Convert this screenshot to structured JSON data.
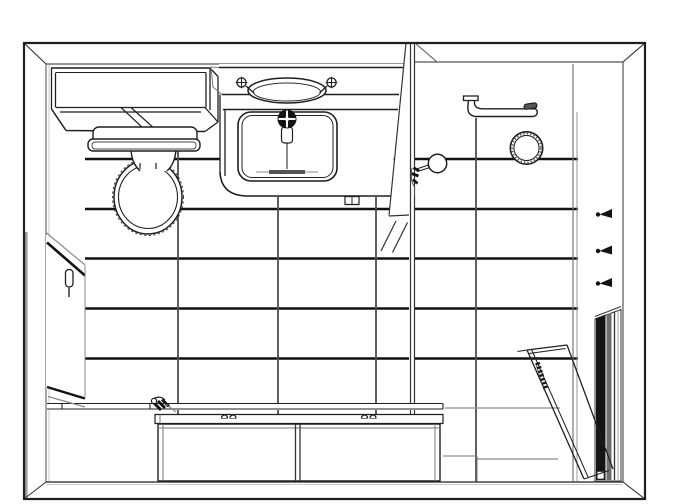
{
  "palette": {
    "paper": "#ffffff",
    "ink": "#1f1f1f",
    "heavy_line": "#111111",
    "mid_line": "#4f4f4f",
    "light_line": "#8a8a8a",
    "dark_fill": "#141414",
    "steel_fill": "#6e6e6e",
    "track_gray": "#555555"
  },
  "scene": {
    "type": "cad_line_drawing",
    "view": "one-point perspective interior elevation of a bathroom, black line art on white, no text",
    "room": {
      "frame_px": {
        "x": 24,
        "y": 43,
        "w": 621,
        "h": 456
      },
      "tile_rows_y": [
        159,
        209,
        258,
        308,
        358,
        408,
        459
      ],
      "tile_cols_x": [
        85,
        178,
        278,
        376,
        476,
        576
      ]
    },
    "fixtures": [
      {
        "id": "wall-cabinet",
        "desc": "two-tier wall cabinet above toilet",
        "bbox": [
          51,
          64,
          167,
          69
        ]
      },
      {
        "id": "toilet",
        "desc": "toilet with tank, lip and elongated bowl",
        "bbox": [
          88,
          127,
          112,
          109
        ]
      },
      {
        "id": "vanity",
        "desc": "vanity counter with oval vessel sink, two cross handles, rectangular basin, dark center faucet and drain",
        "bbox": [
          211,
          64,
          195,
          141
        ]
      },
      {
        "id": "entry-door",
        "desc": "door on left wall shown edge-on with capsule handle",
        "bbox": [
          46,
          232,
          39,
          175
        ]
      },
      {
        "id": "partition-wall",
        "desc": "full-height partition beside vanity with foot hatching",
        "bbox": [
          381,
          43,
          56,
          438
        ]
      },
      {
        "id": "shower-mixer",
        "desc": "mixer valve with round knob and lever",
        "bbox": [
          411,
          155,
          36,
          41
        ]
      },
      {
        "id": "towel-bar",
        "desc": "wall-mounted towel bar with flange and end bracket",
        "bbox": [
          463,
          96,
          75,
          22
        ]
      },
      {
        "id": "towel-ring",
        "desc": "double-circle towel ring with stippled band",
        "bbox": [
          510,
          132,
          33,
          33
        ]
      },
      {
        "id": "robe-hooks",
        "desc": "three black robe hooks on right wall",
        "count": 3,
        "bbox": [
          596,
          209,
          16,
          80
        ]
      },
      {
        "id": "shower-door",
        "desc": "glass shower door ajar with hatched handle",
        "bbox": [
          517,
          344,
          96,
          135
        ]
      },
      {
        "id": "shower-door-track",
        "desc": "dark vertical door frame / track on right wall",
        "bbox": [
          595,
          306,
          26,
          175
        ]
      },
      {
        "id": "bathtub",
        "desc": "paneled tub deck along bottom with spout and two pairs of deck knobs",
        "bbox": [
          47,
          396,
          430,
          86
        ]
      }
    ]
  }
}
